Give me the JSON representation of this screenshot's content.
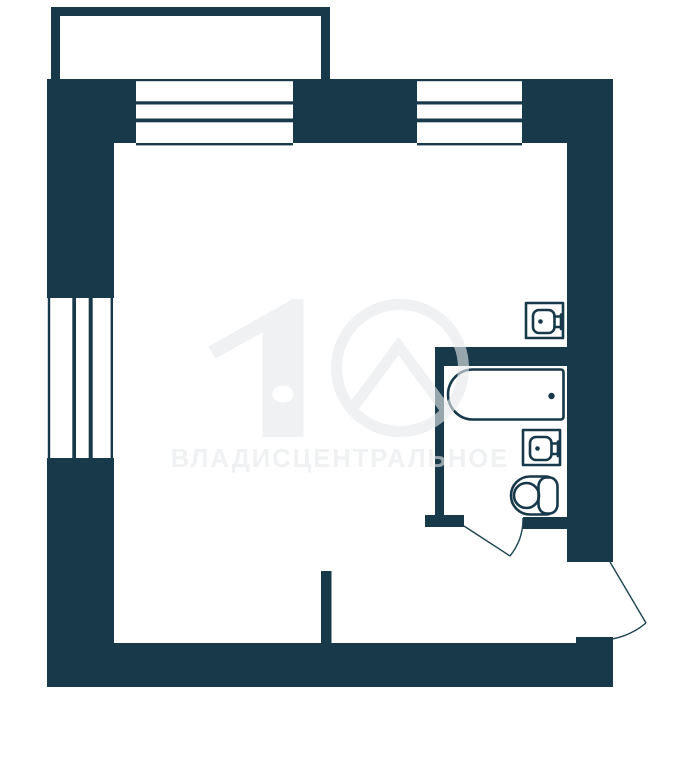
{
  "colors": {
    "wall": "#17394A",
    "door_line": "#1C4252",
    "watermark": "#E6E9EB",
    "background": "#FFFFFF"
  },
  "watermark": {
    "text": "ВЛАДИСЦЕНТРАЛЬНОЕ",
    "logo": "house-key-digit-and-circle-roof-emblem"
  },
  "floorplan": {
    "type": "apartment-floor-plan",
    "balcony": "balcony-top-left",
    "windows": [
      "top-left-window-3-pane",
      "top-right-window-3-pane",
      "left-window-3-pane"
    ],
    "fixtures": [
      "bathtub-icon",
      "wash-basin-icon",
      "toilet-icon",
      "kitchen-sink-icon"
    ],
    "doors": [
      "bathroom-door-swing-arc",
      "entrance-door-swing-arc"
    ]
  }
}
